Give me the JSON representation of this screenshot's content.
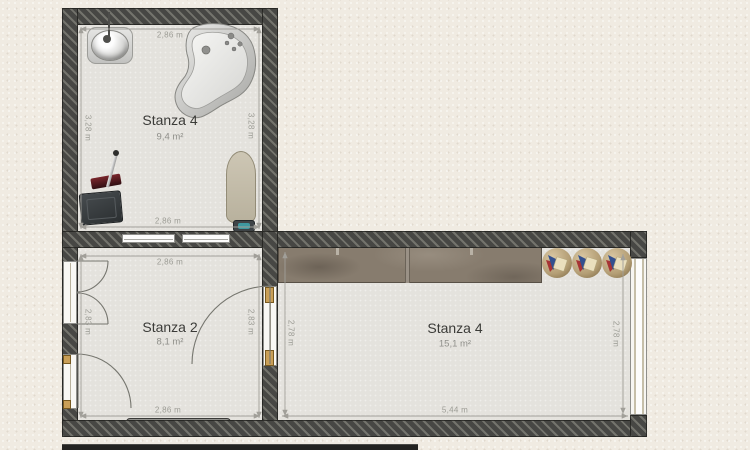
{
  "plan": {
    "rooms": [
      {
        "id": "bathroom",
        "name": "Stanza 4",
        "area": "9,4 m²",
        "dim_top": "2,86 m",
        "dim_bottom": "2,86 m",
        "dim_left": "3,28 m",
        "dim_right": "3,28 m"
      },
      {
        "id": "stanza2",
        "name": "Stanza 2",
        "area": "8,1 m²",
        "dim_top": "2,86 m",
        "dim_bottom": "2,86 m",
        "dim_left": "2,83 m",
        "dim_right": "2,83 m"
      },
      {
        "id": "living",
        "name": "Stanza 4",
        "area": "15,1 m²",
        "dim_bottom": "5,44 m",
        "dim_left": "2,78 m",
        "dim_right": "2,78 m"
      }
    ],
    "furniture": [
      "sink",
      "bathtub",
      "ironing-board",
      "iron",
      "storage-box",
      "cleaning-tool",
      "radiator",
      "wardrobe",
      "round-chair",
      "round-chair",
      "round-chair"
    ],
    "colors": {
      "paper": "#f0ebe2",
      "floor": "#e4e2dd",
      "wall": "#474744",
      "wardrobe": "#877c6e",
      "hinge": "#c99f57",
      "dimension_text": "#9c9c95"
    }
  }
}
